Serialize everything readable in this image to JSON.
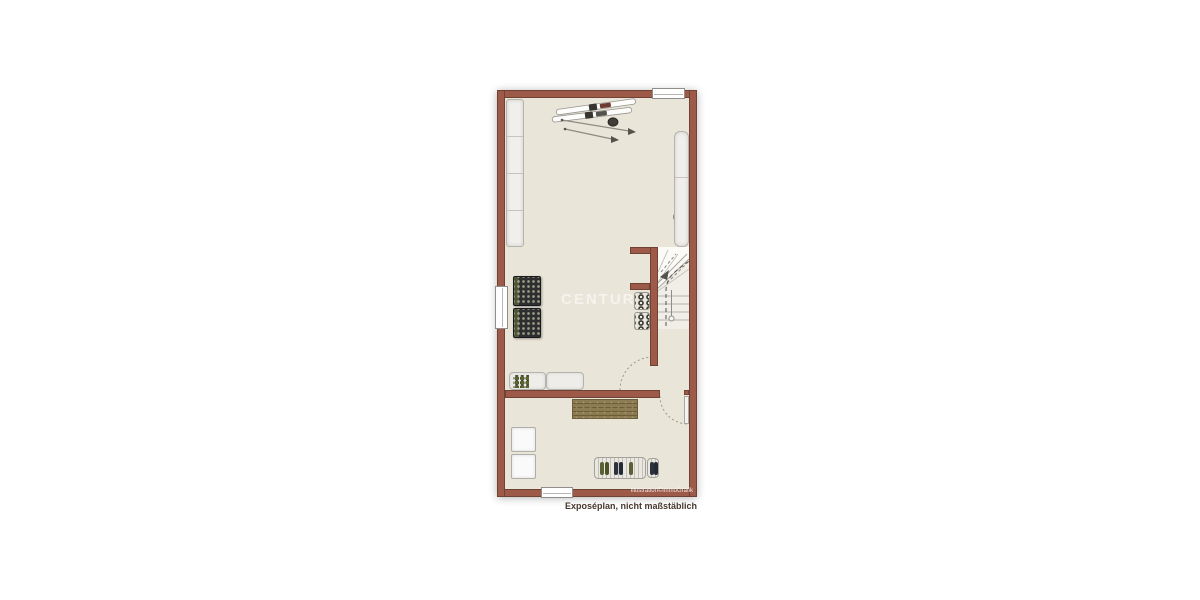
{
  "watermark": {
    "text": "CENTURY 21"
  },
  "footer": {
    "caption": "Exposéplan, nicht maßstäblich",
    "credit": "Illustration©immoGrafik"
  },
  "colors": {
    "wall": "#9d5a48",
    "wall-edge": "#6f4234",
    "floor": "#eae5d9",
    "mat": "#8d7c52",
    "dark-rack": "#2e2e30",
    "accent-olive": "#5f6b3a"
  },
  "plan": {
    "type": "floor-plan",
    "visible_features": [
      "staircase",
      "ski-equipment",
      "wardrobe-cabinets",
      "boiler-unit",
      "storage-racks",
      "sideboard",
      "doormat",
      "appliances",
      "shoe-bench",
      "windows",
      "doors"
    ]
  }
}
